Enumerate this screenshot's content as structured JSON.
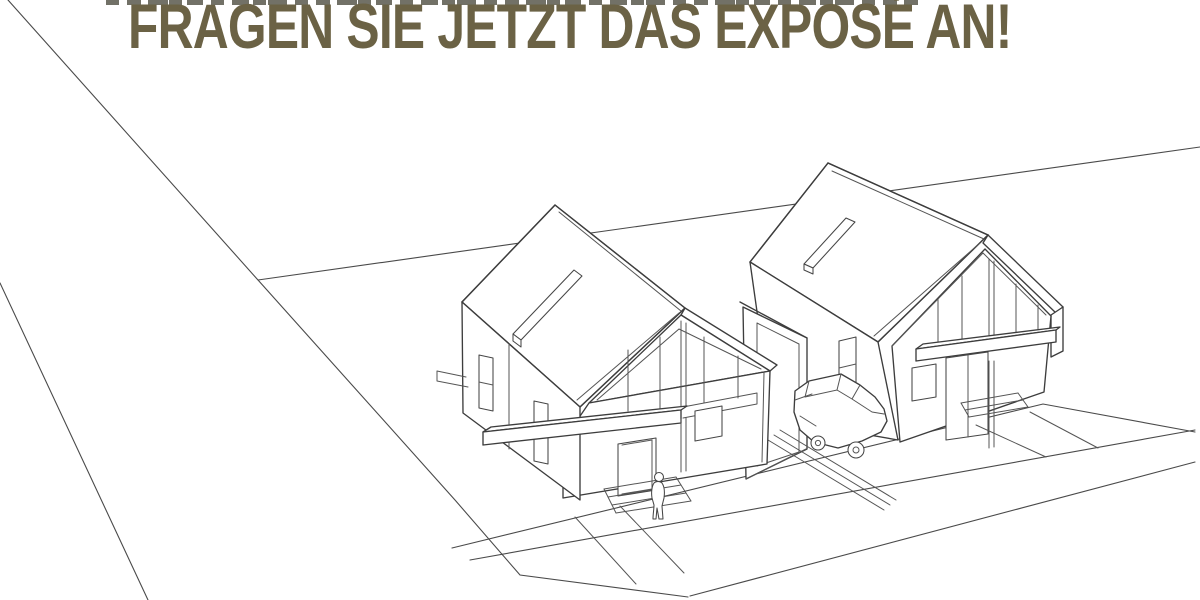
{
  "headline": {
    "text": "FRAGEN SIE JETZT DAS EXPOSÉ AN!",
    "color": "#6b6245"
  },
  "canvas": {
    "width": 1200,
    "height": 600,
    "background": "#ffffff",
    "line_color": "#3d3d3d",
    "hatch_color": "#a9a9a9"
  },
  "illustration": {
    "type": "architectural perspective line drawing",
    "elements": [
      "left-gabled-house",
      "right-gabled-house",
      "garage-between-houses",
      "parked-car",
      "person-at-entrance-steps",
      "roof-skylight-strips",
      "road-and-sidewalk-perspective-lines",
      "cropped-text-remnant-top-edge"
    ]
  }
}
